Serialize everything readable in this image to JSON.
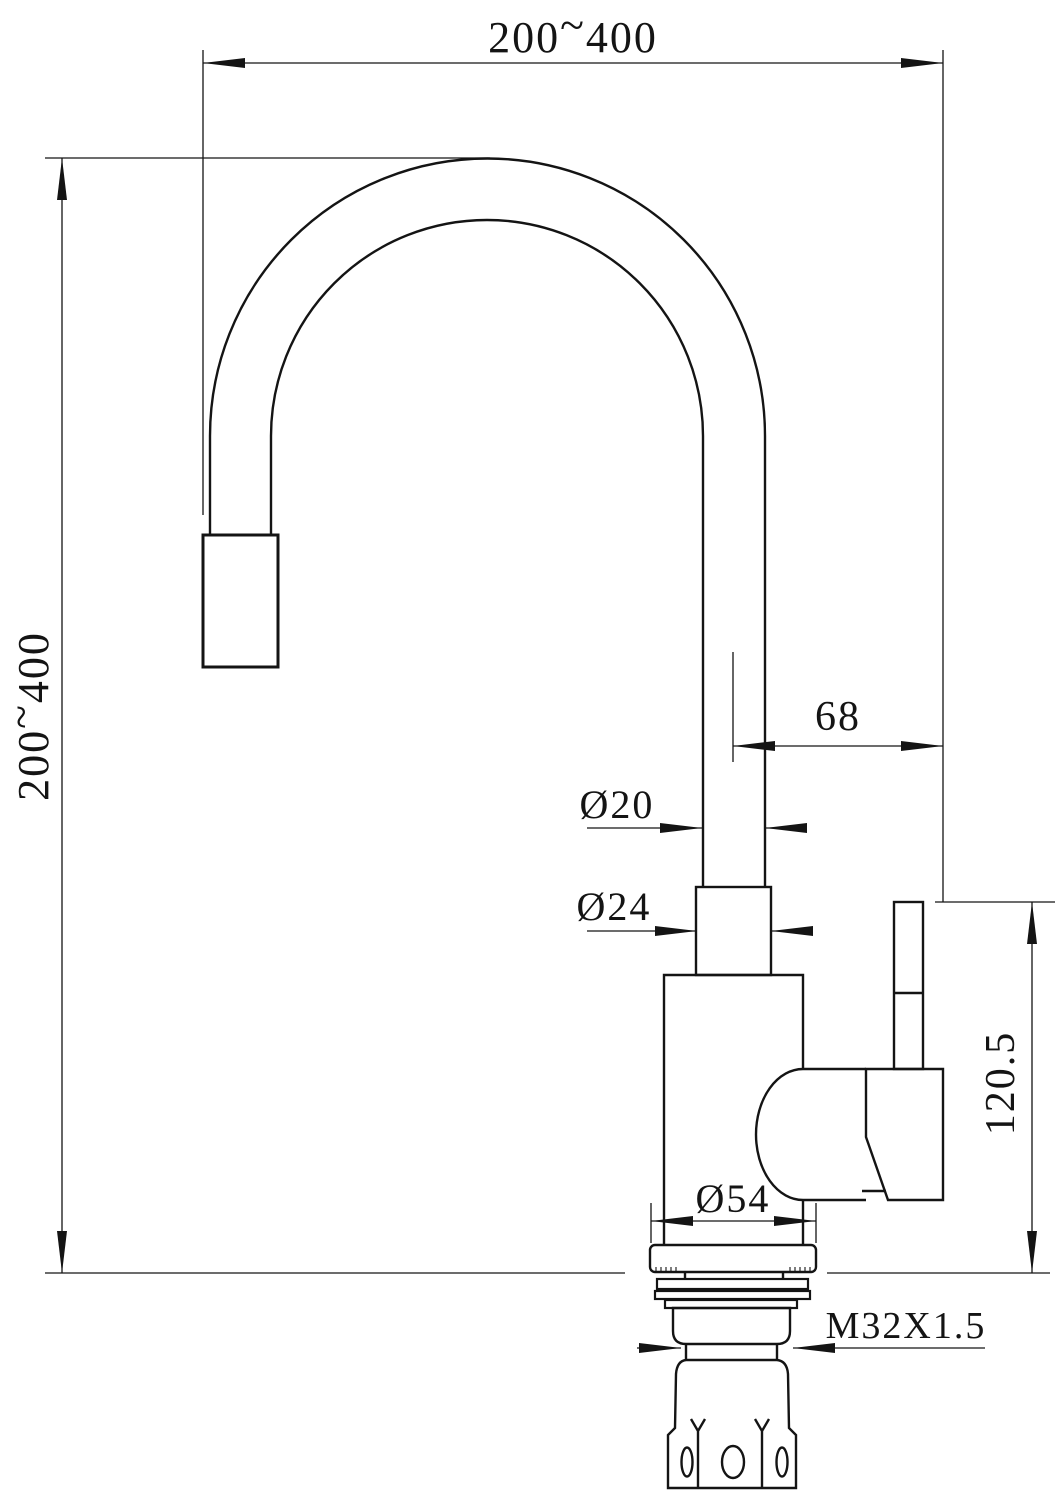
{
  "colors": {
    "line": "#141414",
    "background": "#ffffff"
  },
  "dimensions": {
    "top_width": {
      "min": "200",
      "tilde": "~",
      "max": "400"
    },
    "side_height": {
      "min": "200",
      "tilde": "~",
      "max": "400"
    },
    "handle_offset": "68",
    "spout_tube_diameter": "Ø20",
    "collar_diameter": "Ø24",
    "base_diameter": "Ø54",
    "handle_height": "120.5",
    "mounting_thread": "M32X1.5"
  }
}
